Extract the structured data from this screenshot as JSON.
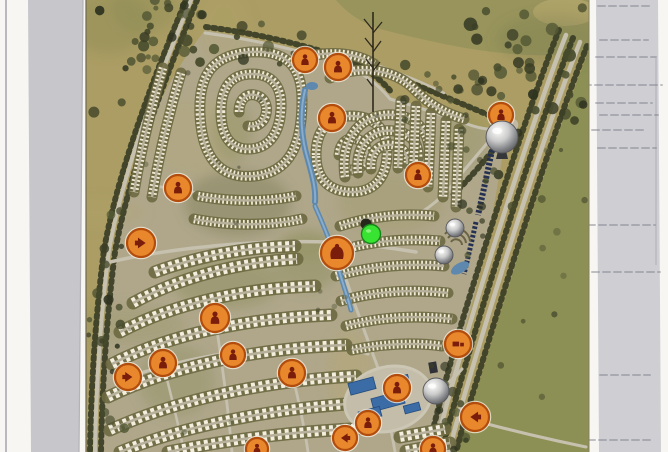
{
  "page": {
    "width": 668,
    "height": 452,
    "background": "#f7f6f2",
    "left_edge_line": {
      "x": 5,
      "width": 2,
      "color": "#b9b9bd"
    },
    "left_scan_band": {
      "top_x1": 28,
      "top_x2": 83,
      "bottom_x1": 31,
      "bottom_x2": 79,
      "color": "#c7c7cb"
    },
    "right_scan_band": {
      "top_x1": 596,
      "top_x2": 658,
      "bottom_x1": 599,
      "bottom_x2": 661,
      "color": "#cfcfd3"
    },
    "bleed_marks": {
      "color": "#7d7d89",
      "opacity": 0.45,
      "lines": [
        [
          6,
          598,
          652
        ],
        [
          40,
          600,
          648
        ],
        [
          57,
          596,
          656
        ],
        [
          85,
          584,
          662
        ],
        [
          103,
          596,
          652
        ],
        [
          115,
          600,
          658
        ],
        [
          130,
          592,
          646
        ],
        [
          148,
          598,
          656
        ],
        [
          225,
          588,
          655
        ],
        [
          272,
          592,
          660
        ],
        [
          375,
          600,
          650
        ],
        [
          440,
          588,
          652
        ]
      ],
      "vertical_line": {
        "x": 656,
        "y1": 58,
        "y2": 265
      }
    }
  },
  "map": {
    "left": 86,
    "right": 589,
    "palette": {
      "base": "#ab9d64",
      "field": "#8d9055",
      "field_top": "#96945b",
      "dev_ground": "#b0a88d",
      "road": "#c6c0af",
      "belt": "#6e6a42",
      "villa": "#f1ead6",
      "apartment": "#f3eedd",
      "tree": "#3a3e25",
      "water": "#5e88ae",
      "water_light": "#8fb3cf",
      "mall_blue": "#3c6ca6",
      "plaza": "#c4bda9",
      "cars_strip": "#253052",
      "edge_line": "#6e6852"
    },
    "north_mark": {
      "x": 373,
      "y_top": 12,
      "y_bottom": 112,
      "color": "#2e2a1c"
    }
  },
  "markers": {
    "orange_style": {
      "fill": "#e8872b",
      "ring": "#b34d0e",
      "glyph": "#7a1d0b",
      "halo": "#f8f0e2"
    },
    "orange": [
      {
        "x": 305,
        "y": 60,
        "r": 12,
        "icon": "figure",
        "rot": 0
      },
      {
        "x": 338,
        "y": 67,
        "r": 13,
        "icon": "figure",
        "rot": 0
      },
      {
        "x": 332,
        "y": 118,
        "r": 13,
        "icon": "figure",
        "rot": 0
      },
      {
        "x": 178,
        "y": 188,
        "r": 13,
        "icon": "figure",
        "rot": 0
      },
      {
        "x": 418,
        "y": 175,
        "r": 12,
        "icon": "figure",
        "rot": 0
      },
      {
        "x": 141,
        "y": 243,
        "r": 14,
        "icon": "arrow",
        "rot": 180
      },
      {
        "x": 337,
        "y": 253,
        "r": 16,
        "icon": "hand",
        "rot": 0
      },
      {
        "x": 501,
        "y": 115,
        "r": 12,
        "icon": "figure",
        "rot": 0
      },
      {
        "x": 215,
        "y": 318,
        "r": 14,
        "icon": "figure",
        "rot": 0
      },
      {
        "x": 233,
        "y": 355,
        "r": 12,
        "icon": "figure",
        "rot": 0
      },
      {
        "x": 163,
        "y": 363,
        "r": 13,
        "icon": "figure",
        "rot": 0
      },
      {
        "x": 128,
        "y": 377,
        "r": 13,
        "icon": "arrow",
        "rot": 180
      },
      {
        "x": 292,
        "y": 373,
        "r": 13,
        "icon": "figure",
        "rot": 0
      },
      {
        "x": 397,
        "y": 388,
        "r": 13,
        "icon": "figure",
        "rot": 0
      },
      {
        "x": 368,
        "y": 423,
        "r": 12,
        "icon": "figure",
        "rot": 0
      },
      {
        "x": 345,
        "y": 438,
        "r": 12,
        "icon": "arrow",
        "rot": 0
      },
      {
        "x": 433,
        "y": 449,
        "r": 12,
        "icon": "figure",
        "rot": 0
      },
      {
        "x": 475,
        "y": 417,
        "r": 14,
        "icon": "arrow",
        "rot": 0
      },
      {
        "x": 458,
        "y": 344,
        "r": 13,
        "icon": "truck",
        "rot": 0
      },
      {
        "x": 257,
        "y": 449,
        "r": 11,
        "icon": "figure",
        "rot": 0
      }
    ],
    "spheres": [
      {
        "x": 502,
        "y": 137,
        "r": 16,
        "pedestal": true
      },
      {
        "x": 455,
        "y": 228,
        "r": 9,
        "pedestal": false
      },
      {
        "x": 444,
        "y": 255,
        "r": 9,
        "pedestal": false
      },
      {
        "x": 436,
        "y": 391,
        "r": 13,
        "pedestal": false
      }
    ],
    "green_dot": {
      "x": 371,
      "y": 234,
      "r": 9.5,
      "fill": "#38e431",
      "ring": "#17861a"
    },
    "dark_dot": {
      "x": 366,
      "y": 224,
      "r": 5.5,
      "fill": "#26281c"
    }
  }
}
